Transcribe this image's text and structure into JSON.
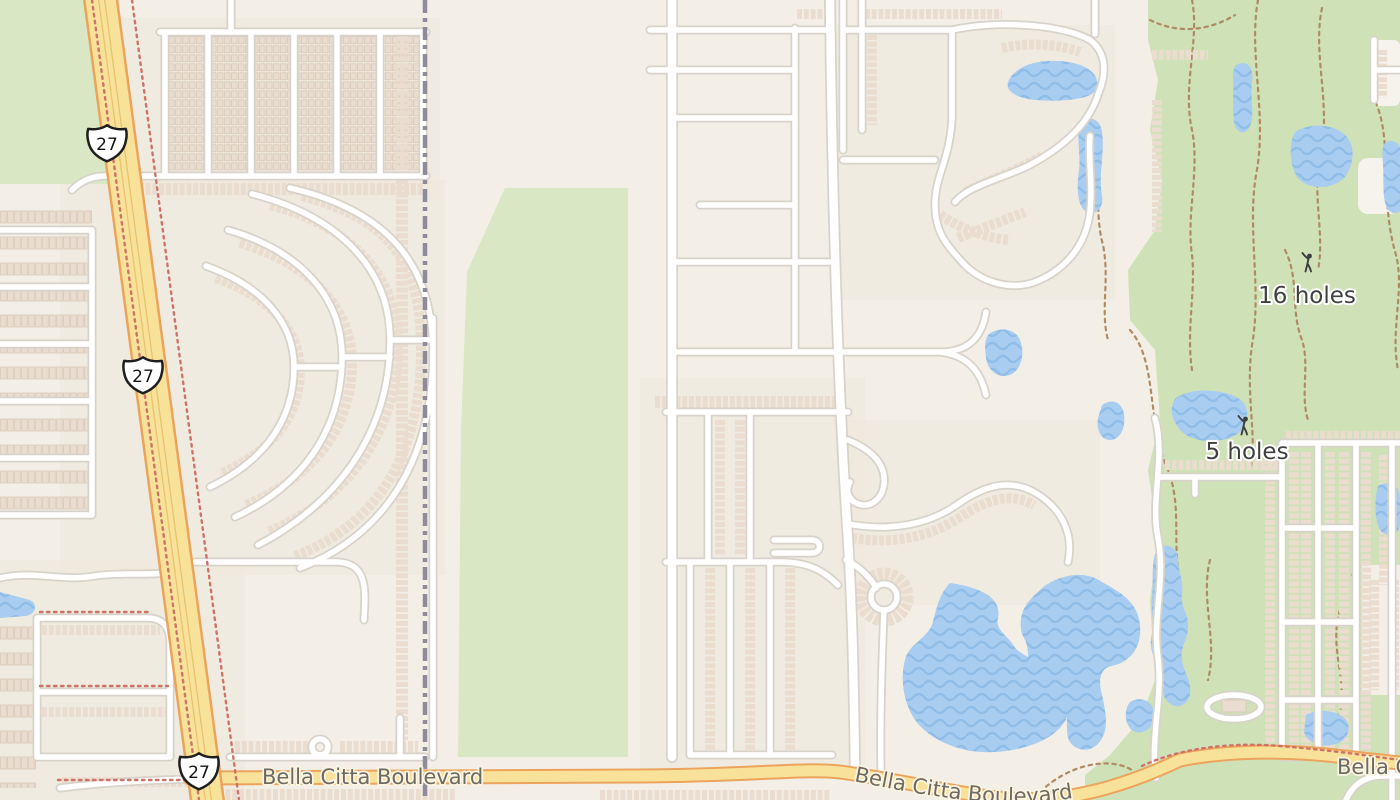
{
  "map": {
    "description": "Street map of residential neighborhoods and a golf community along US Route 27 and Bella Citta Boulevard",
    "labels": {
      "route_shield": "27",
      "golf_16_holes": "16 holes",
      "golf_5_holes": "5 holes",
      "boulevard": "Bella Citta Boulevard",
      "boulevard_curved": "Bella Citta Boulevard",
      "boulevard_right": "Bella Citta"
    },
    "icons": {
      "golfer": "golfer-icon",
      "shield": "us-route-shield"
    },
    "colors": {
      "background": "#f3efe7",
      "residential_tint": "#efe7dc",
      "park_green": "#d9e7c5",
      "golf_green": "#cfe1b7",
      "water": "#a9cdf1",
      "water_wave": "#8fbde8",
      "road_fill": "#ffffff",
      "road_casing": "#d8d3ca",
      "highway_fill": "#f8e299",
      "highway_casing": "#eca45c",
      "building": "#eadcce",
      "building_outline": "#d9c8b8",
      "boundary": "#8e8c9c",
      "trail_red": "#cf7268",
      "path_brown": "#b18a63",
      "label_dark": "#3f4141",
      "label_road": "#6f6a60"
    }
  }
}
